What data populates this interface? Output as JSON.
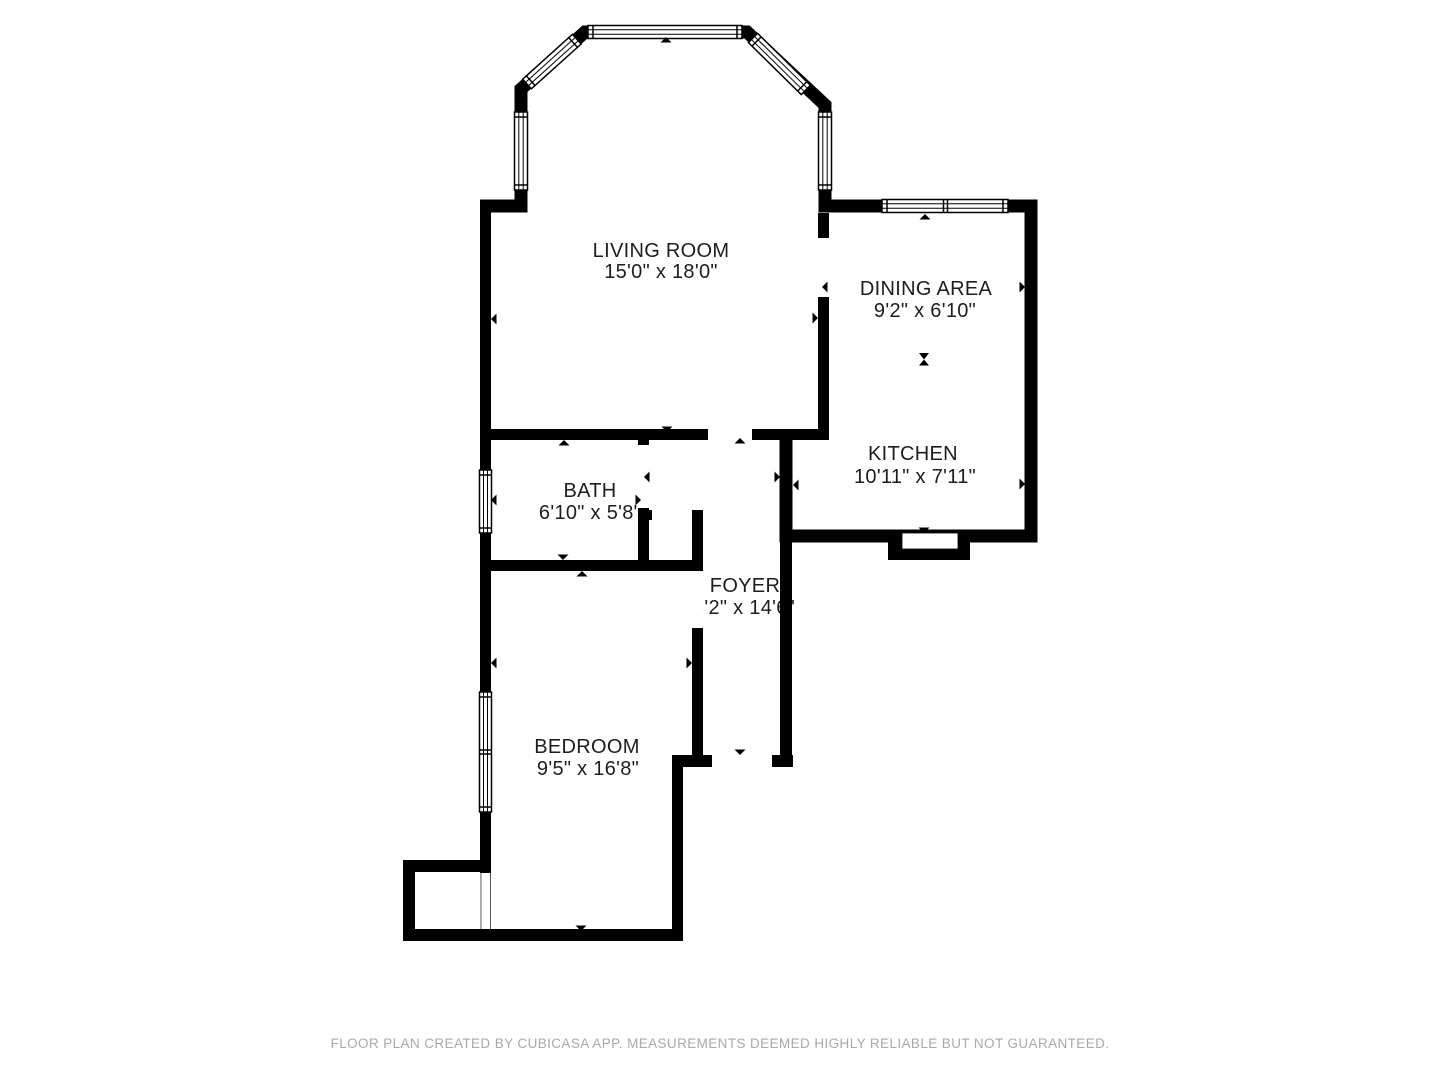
{
  "colors": {
    "background": "#ffffff",
    "walls": "#000000",
    "label_text": "#1d1d1d",
    "footer_text": "#a9a9a9"
  },
  "rooms": [
    {
      "name": "LIVING ROOM",
      "dimensions": "15'0\" x 18'0\""
    },
    {
      "name": "DINING AREA",
      "dimensions": "9'2\" x 6'10\""
    },
    {
      "name": "KITCHEN",
      "dimensions": "10'11\" x 7'11\""
    },
    {
      "name": "BATH",
      "dimensions": "6'10\" x 5'8\""
    },
    {
      "name": "FOYER",
      "dimensions": "6'2\" x 14'6\""
    },
    {
      "name": "BEDROOM",
      "dimensions": "9'5\" x 16'8\""
    }
  ],
  "footer": {
    "disclaimer": "FLOOR PLAN CREATED BY CUBICASA APP. MEASUREMENTS DEEMED HIGHLY RELIABLE BUT NOT GUARANTEED."
  }
}
